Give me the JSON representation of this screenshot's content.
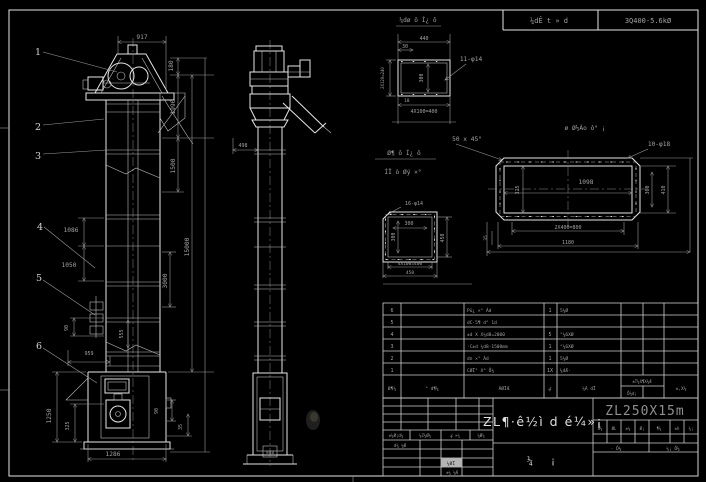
{
  "colors": {
    "background": "#000000",
    "line": "#e6e6e6",
    "dim": "#9c9c9c",
    "bright": "#d8d8d8",
    "model_grey": "#8f8f8f"
  },
  "header_bar": {
    "left_cell": "¼dÊ t » d",
    "right_cell": "3Q400-5.6kØ"
  },
  "front_view": {
    "balloons": [
      "1",
      "2",
      "3",
      "4",
      "5",
      "6"
    ],
    "dims": {
      "top_width": "917",
      "d180": "180",
      "d1990": "1990",
      "d1500": "1500",
      "d15000": "15000",
      "d3000": "3000",
      "d1086": "1086",
      "d1050": "1050",
      "d90_left": "90",
      "d555": "555",
      "d959": "959",
      "d1250": "1250",
      "d325": "325",
      "d1286": "1286",
      "d90_right": "90",
      "d35": "35"
    }
  },
  "side_view": {
    "dims": {
      "d498": "498",
      "d948": "948"
    }
  },
  "detail_a": {
    "title": "¼dø ô Í¿ ô",
    "holes": "11-φ14",
    "dims": {
      "w440": "440",
      "d30": "30",
      "left": "2X120=240",
      "inner": "300",
      "d10": "10",
      "bottom": "4X100=400"
    }
  },
  "notes": {
    "line1": "Ø¶ ô Í¿ ô",
    "line2": "ÍÏ ò Øý ×°",
    "chamfer": "50 x 45°"
  },
  "part_c": {
    "title": "ø Ø½Ào ô° ¡",
    "holes": "10-φ18",
    "dims": {
      "w1098": "1098",
      "v325": "325",
      "v360": "360",
      "v410": "410",
      "b800": "2X400=800",
      "b1180": "1180",
      "l35": "35"
    }
  },
  "detail_b": {
    "holes": "16-φ14",
    "dims": {
      "h300": "300",
      "v300": "300",
      "r450": "450",
      "b400": "4X100=400",
      "b450": "450"
    }
  },
  "bom": {
    "headers": {
      "seq": "Ø¶¼",
      "code": "° d¶¼",
      "name": "ÃØÏÆ",
      "qty": "ؼ",
      "material": "¼Ã dÏ",
      "weight": "±T¼X¶X¼Æ",
      "weight_sub": "Õ¼d¡",
      "notes": "±,X¼"
    },
    "rows": [
      {
        "seq": "6",
        "code": "",
        "name": "Pü¿ ×° Àd",
        "qty": "1",
        "material": "5¼Ø"
      },
      {
        "seq": "5",
        "code": "",
        "name": "dС·5¶ d° 1d",
        "qty": "",
        "material": ""
      },
      {
        "seq": "4",
        "code": "",
        "name": "±d X X¼d8=2000",
        "qty": "5",
        "material": "°¼6XØ"
      },
      {
        "seq": "3",
        "code": "",
        "name": "·C±d ¼d8-1500mm",
        "qty": "1",
        "material": "°¼6XØ"
      },
      {
        "seq": "2",
        "code": "",
        "name": "dп ×° Àd",
        "qty": "1",
        "material": "5¼Ø"
      },
      {
        "seq": "1",
        "code": "",
        "name": "CØÏ° X° Õ¼",
        "qty": "1X",
        "material": "¼4Æ·"
      }
    ]
  },
  "title_block": {
    "model": "ZL250X15m",
    "drawing_name": "ZL¶·ê½ì d é¼»¡",
    "doc_label_l": "¼",
    "doc_label_r": "¡",
    "rev_row": [
      "±¼Ø¡d¼",
      "¼Z¼Ø¼",
      "ؼ ×¼",
      "¼Ø¼"
    ],
    "left_rows": {
      "r1": "d¼ ¼Ø",
      "grey": "¼ØÏ",
      "r3": "±¼ ¼Æ"
    },
    "small_row": [
      "d¼",
      "ØL",
      "±¼",
      "Ø¡",
      "¶¼",
      "±h",
      "¼¡"
    ],
    "sig_left": "· Õ¼",
    "sig_right": "¼¡ Õ¼"
  }
}
